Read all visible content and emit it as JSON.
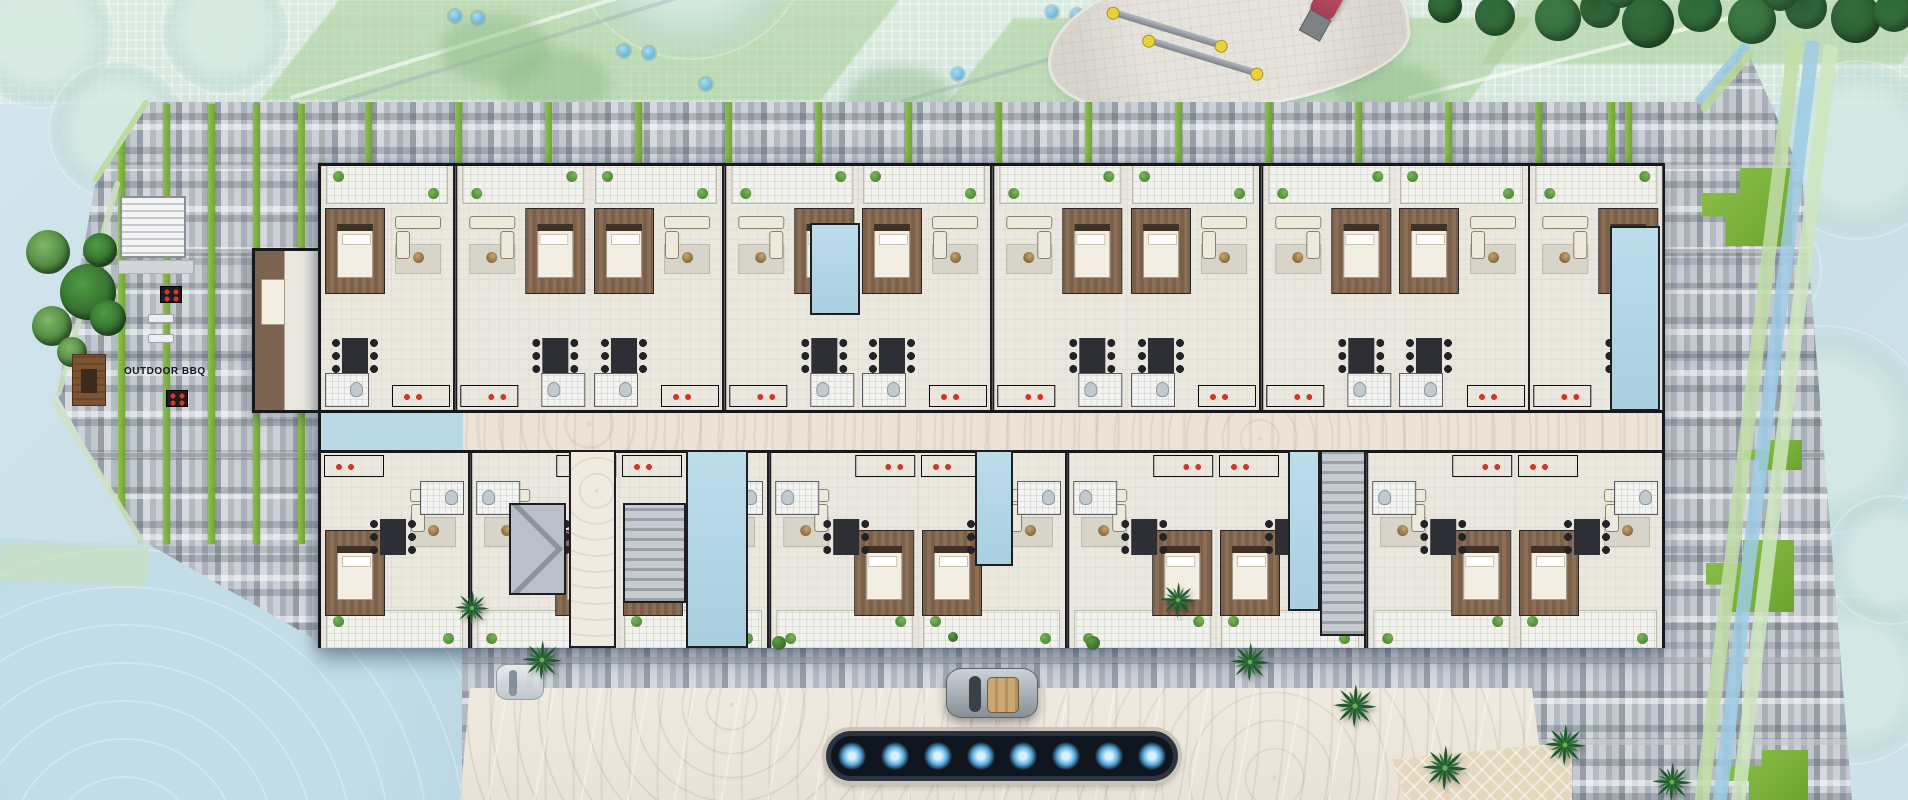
{
  "scene": {
    "type": "architectural-site-floor-plan",
    "description": "Top-down rendered floor plan of an elongated apartment building with landscaped grounds, playground, outdoor BBQ area, entry driveway with car and lit reflecting pool"
  },
  "labels": {
    "outdoor_bbq": "OUTDOOR BBQ"
  },
  "counts": {
    "top_row_units": 10,
    "bottom_row_units": 9,
    "pool_lights": 8,
    "palm_trees": 8
  },
  "palette": {
    "water": "#c6dde7",
    "plaza": "#dcebe0",
    "paving_grey": "#b4bac2",
    "paving_dark": "#4a4f58",
    "planter_green": "#7cb63c",
    "grass_green": "#7ab648",
    "floor_cream": "#eae7df",
    "wood_floor": "#83664d",
    "wall_dark": "#17171c",
    "corridor_marble": "#ebe3d8",
    "shaft_blue": "#b5d8e8",
    "pool_dark": "#10161f",
    "pool_light_glow": "#57aae0",
    "slide_red": "#c2475e",
    "swing_cap_yellow": "#e8d23c",
    "palm_green": "#1e5a2c",
    "bbq_red": "#e03328"
  },
  "features": [
    "playground-with-swing-set-and-slide",
    "outdoor-bbq-terrace",
    "reflecting-pool-with-lights",
    "entry-driveway-with-car",
    "palm-trees",
    "vertical-planter-stripes",
    "apartment-units-with-furniture"
  ],
  "decor": {
    "green_stripes": [
      [
        118,
        104,
        440
      ],
      [
        163,
        104,
        440
      ],
      [
        208,
        104,
        440
      ],
      [
        253,
        104,
        440
      ],
      [
        298,
        104,
        440
      ],
      [
        365,
        102,
        66
      ],
      [
        455,
        102,
        66
      ],
      [
        545,
        102,
        66
      ],
      [
        635,
        102,
        66
      ],
      [
        725,
        102,
        66
      ],
      [
        815,
        102,
        66
      ],
      [
        905,
        102,
        66
      ],
      [
        995,
        102,
        66
      ],
      [
        1085,
        102,
        66
      ],
      [
        1175,
        102,
        66
      ],
      [
        1265,
        102,
        66
      ],
      [
        1355,
        102,
        66
      ],
      [
        1445,
        102,
        66
      ],
      [
        1535,
        102,
        66
      ],
      [
        1625,
        102,
        66
      ],
      [
        1608,
        102,
        320
      ]
    ],
    "grass_patches": [
      [
        1702,
        168,
        90,
        78
      ],
      [
        1744,
        440,
        58,
        30
      ],
      [
        1706,
        540,
        88,
        72
      ],
      [
        1728,
        750,
        80,
        50
      ]
    ],
    "blue_shrubs": [
      [
        449,
        10
      ],
      [
        472,
        12
      ],
      [
        618,
        45
      ],
      [
        643,
        47
      ],
      [
        1046,
        6
      ],
      [
        1071,
        9
      ],
      [
        1156,
        60
      ],
      [
        1181,
        63
      ],
      [
        952,
        68
      ],
      [
        700,
        78
      ]
    ],
    "palm_shadows": [
      [
        500,
        48
      ],
      [
        845,
        66
      ],
      [
        1205,
        24
      ],
      [
        1335,
        62
      ],
      [
        440,
        14
      ]
    ],
    "ghost_trees": [
      [
        40,
        34,
        150
      ],
      [
        225,
        30,
        130
      ],
      [
        118,
        130,
        140
      ],
      [
        690,
        -60,
        240
      ],
      [
        1858,
        150,
        180
      ],
      [
        1826,
        430,
        210
      ],
      [
        1852,
        680,
        170
      ],
      [
        1762,
        270,
        120
      ],
      [
        1890,
        560,
        130
      ]
    ],
    "dark_trees_top": [
      [
        1558,
        18,
        46
      ],
      [
        1600,
        8,
        40
      ],
      [
        1648,
        22,
        52
      ],
      [
        1700,
        10,
        44
      ],
      [
        1752,
        20,
        48
      ],
      [
        1806,
        8,
        42
      ],
      [
        1856,
        18,
        50
      ],
      [
        1894,
        12,
        40
      ],
      [
        1620,
        -10,
        36
      ],
      [
        1780,
        -8,
        38
      ],
      [
        1445,
        6,
        34
      ],
      [
        1495,
        16,
        40
      ]
    ],
    "grove_circles": [
      [
        48,
        252,
        44
      ],
      [
        88,
        292,
        56
      ],
      [
        52,
        326,
        40
      ],
      [
        100,
        250,
        34
      ],
      [
        72,
        352,
        30
      ],
      [
        108,
        318,
        36
      ]
    ],
    "palms": [
      [
        472,
        608,
        38
      ],
      [
        542,
        660,
        44
      ],
      [
        1178,
        600,
        40
      ],
      [
        1250,
        662,
        44
      ],
      [
        1355,
        706,
        48
      ],
      [
        1445,
        768,
        50
      ],
      [
        1565,
        745,
        46
      ],
      [
        1672,
        782,
        44
      ]
    ],
    "shrub_dots": [
      [
        772,
        636,
        14
      ],
      [
        1086,
        636,
        14
      ],
      [
        948,
        632,
        10
      ]
    ],
    "top_shafts": [
      [
        489,
        57,
        50,
        92
      ],
      [
        1289,
        60,
        50,
        185
      ]
    ],
    "bottom_shafts": [
      [
        365,
        284,
        62,
        198
      ],
      [
        654,
        284,
        38,
        116
      ],
      [
        967,
        284,
        32,
        161
      ]
    ],
    "cores": [
      {
        "kind": "lift",
        "x": 188,
        "y": 337,
        "w": 57,
        "h": 92
      },
      {
        "kind": "marble",
        "x": 248,
        "y": 284,
        "w": 47,
        "h": 198
      },
      {
        "kind": "stair",
        "x": 302,
        "y": 337,
        "w": 63,
        "h": 100
      },
      {
        "kind": "stair",
        "x": 999,
        "y": 284,
        "w": 46,
        "h": 186
      }
    ],
    "grills": [
      [
        160,
        286
      ],
      [
        166,
        390
      ]
    ],
    "benches": [
      [
        148,
        314
      ],
      [
        148,
        334
      ]
    ],
    "edge_bars": [
      {
        "x": 1788,
        "y": 40,
        "w": 14,
        "h": 770,
        "rot": 7,
        "color": "#c2dda6"
      },
      {
        "x": 1806,
        "y": 40,
        "w": 14,
        "h": 770,
        "rot": 7,
        "color": "#9ecbe4"
      },
      {
        "x": 1824,
        "y": 44,
        "w": 14,
        "h": 766,
        "rot": 7,
        "color": "#cfe6c0"
      },
      {
        "x": 1694,
        "y": 100,
        "w": 78,
        "h": 10,
        "rot": -50,
        "color": "#9ecbe4"
      },
      {
        "x": 1699,
        "y": 108,
        "w": 78,
        "h": 8,
        "rot": -50,
        "color": "#b9d89a"
      },
      {
        "x": 55,
        "y": 395,
        "w": 223,
        "h": 6,
        "rot": -74.4,
        "color": "#cfe0c0"
      },
      {
        "x": 55,
        "y": 397,
        "w": 176,
        "h": 6,
        "rot": 58,
        "color": "#cfe0c0"
      },
      {
        "x": 150,
        "y": 102,
        "w": 97,
        "h": 6,
        "rot": 123.2,
        "color": "#b9d89a"
      }
    ],
    "walklines": [
      {
        "x": 290,
        "y": 96,
        "w": 620,
        "rot": -17,
        "cls": ""
      },
      {
        "x": 330,
        "y": 102,
        "w": 640,
        "rot": -17,
        "cls": "g"
      },
      {
        "x": 900,
        "y": 100,
        "w": 560,
        "rot": -16,
        "cls": "g"
      },
      {
        "x": 1408,
        "y": 96,
        "w": 420,
        "rot": -14,
        "cls": ""
      }
    ]
  }
}
